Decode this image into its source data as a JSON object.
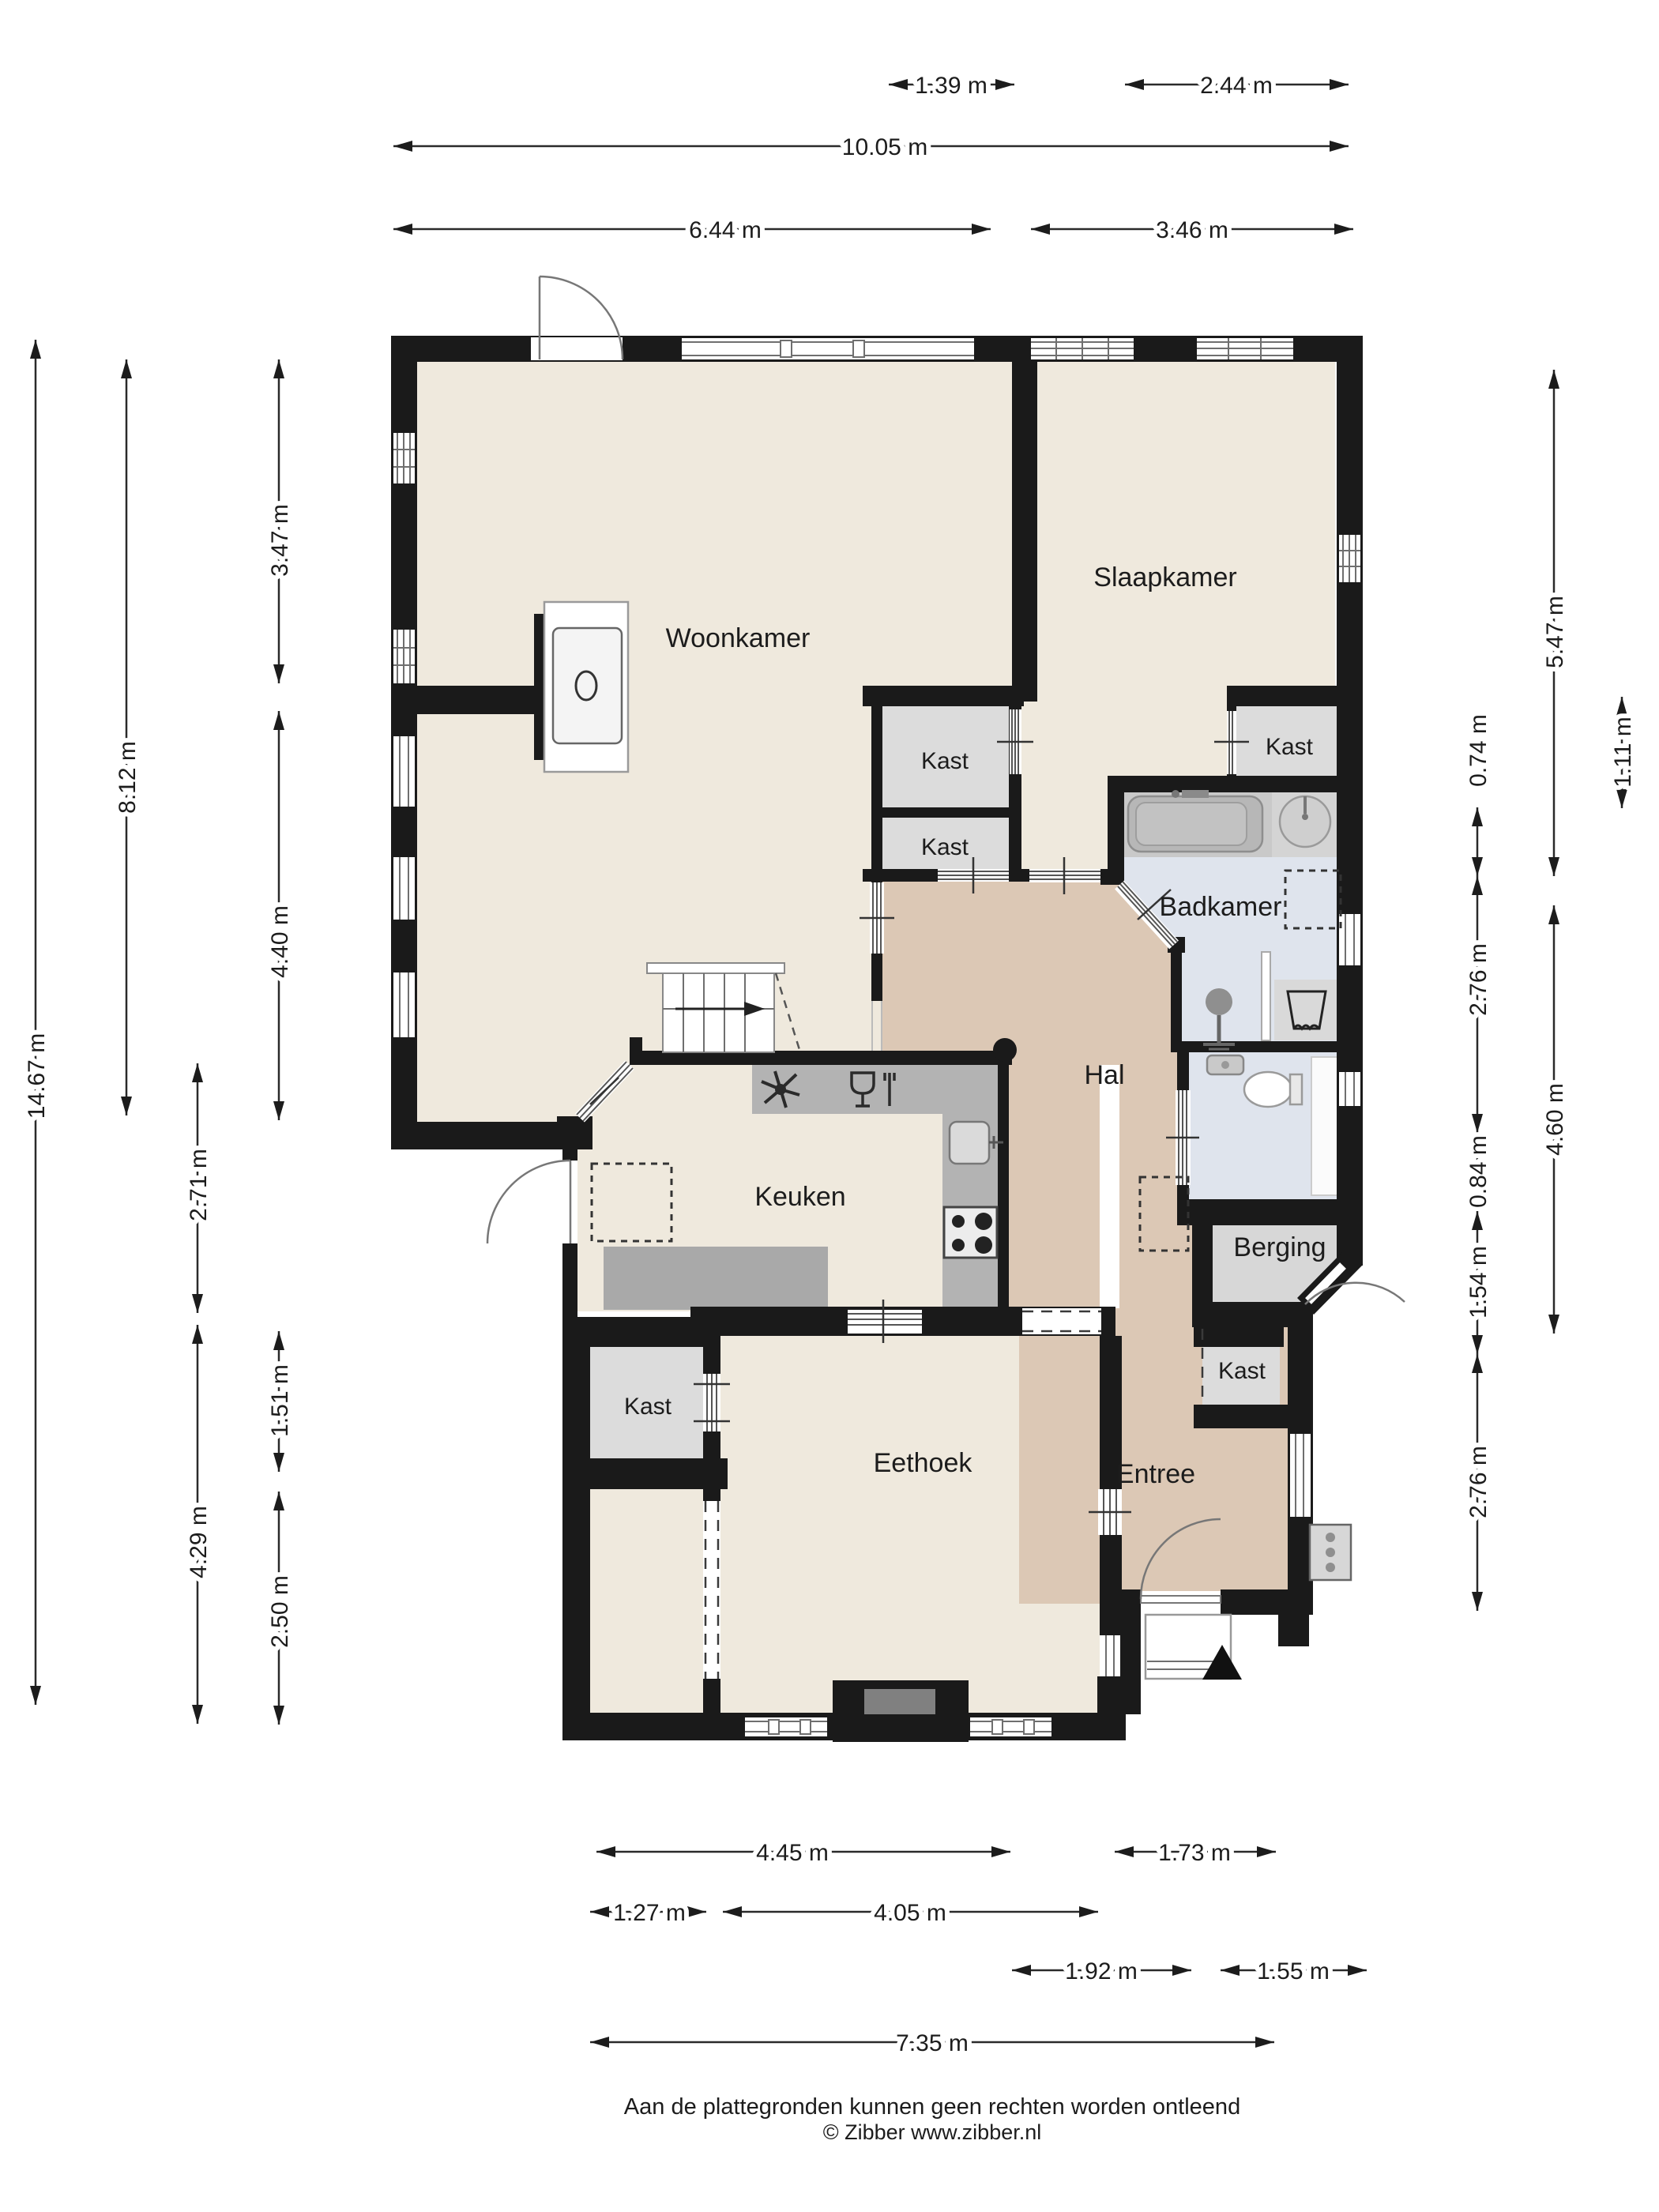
{
  "rooms": {
    "woonkamer": "Woonkamer",
    "slaapkamer": "Slaapkamer",
    "badkamer": "Badkamer",
    "hal": "Hal",
    "keuken": "Keuken",
    "berging": "Berging",
    "eethoek": "Eethoek",
    "entree": "Entree",
    "kast_midden_boven": "Kast",
    "kast_midden_onder": "Kast",
    "kast_slaapkamer": "Kast",
    "kast_eethoek": "Kast",
    "kast_entree": "Kast"
  },
  "dimensions": {
    "top": [
      {
        "label": "1.39 m"
      },
      {
        "label": "2.44 m"
      },
      {
        "label": "10.05 m"
      },
      {
        "label": "6.44 m"
      },
      {
        "label": "3.46 m"
      }
    ],
    "left": [
      {
        "label": "14.67 m"
      },
      {
        "label": "8.12 m"
      },
      {
        "label": "3.47 m"
      },
      {
        "label": "4.40 m"
      },
      {
        "label": "2.71 m"
      },
      {
        "label": "4.29 m"
      },
      {
        "label": "1.51 m"
      },
      {
        "label": "2.50 m"
      }
    ],
    "right": [
      {
        "label": "5.47 m"
      },
      {
        "label": "4.60 m"
      },
      {
        "label": "0.74 m"
      },
      {
        "label": "2.76 m"
      },
      {
        "label": "0.84 m"
      },
      {
        "label": "1.54 m"
      },
      {
        "label": "2.76 m"
      },
      {
        "label": "1.11 m"
      }
    ],
    "bottom": [
      {
        "label": "4.45 m"
      },
      {
        "label": "1.73 m"
      },
      {
        "label": "1.27 m"
      },
      {
        "label": "4.05 m"
      },
      {
        "label": "1.92 m"
      },
      {
        "label": "1.55 m"
      },
      {
        "label": "7.35 m"
      }
    ]
  },
  "footer": {
    "line1": "Aan de plattegronden kunnen geen rechten worden ontleend",
    "line2": "© Zibber www.zibber.nl"
  }
}
